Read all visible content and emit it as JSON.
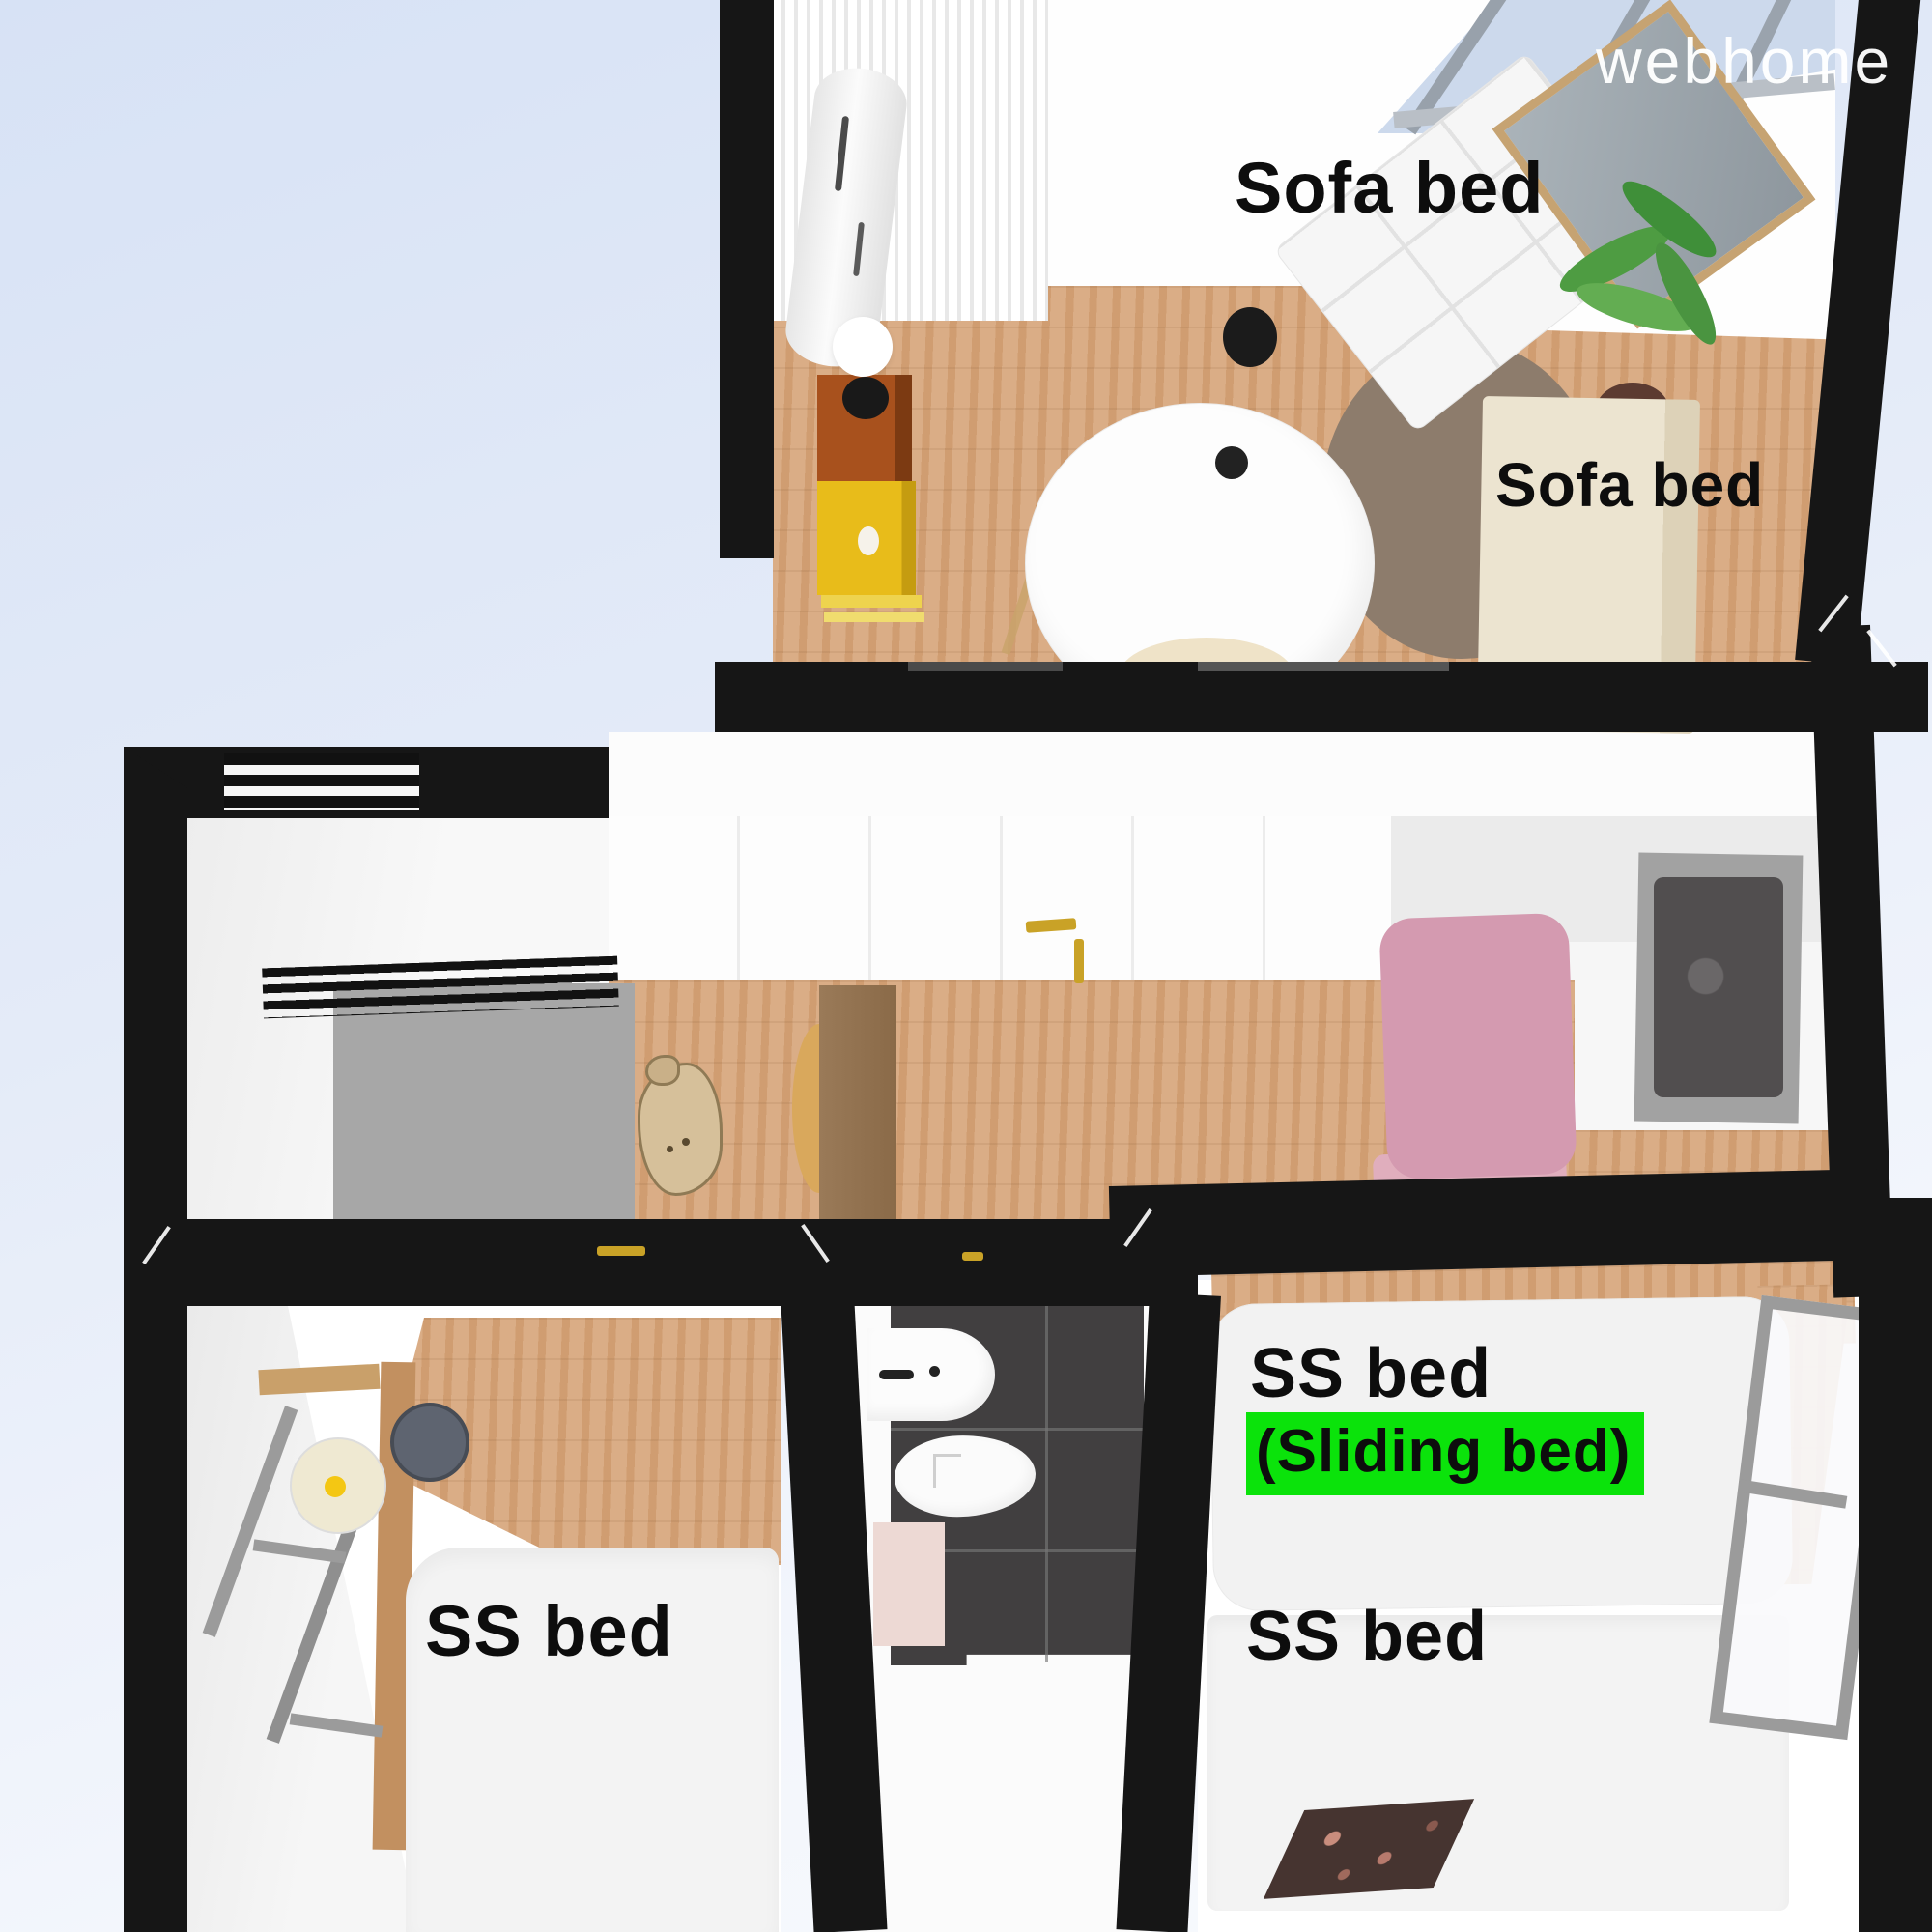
{
  "watermark": {
    "text": "webhome"
  },
  "floor_plan": {
    "living_room": {
      "sofa_bed_label_top": "Sofa bed",
      "sofa_bed_label_side": "Sofa bed"
    },
    "bedroom_left": {
      "bed_label": "SS bed"
    },
    "bedroom_right": {
      "sliding_bed_label": "SS bed",
      "sliding_bed_sublabel": "(Sliding bed)",
      "second_bed_label": "SS bed"
    }
  },
  "colors": {
    "wall": "#161616",
    "wood_floor": "#d6a478",
    "highlight_green": "#0be30b",
    "cabinet_yellow": "#e8bc1a",
    "cabinet_rust": "#a8511d",
    "chair_pink": "#d49ab0",
    "tile_dark": "#413f40",
    "rug_brown": "#8d7c6c",
    "background_sky": "#d9e3f6"
  }
}
